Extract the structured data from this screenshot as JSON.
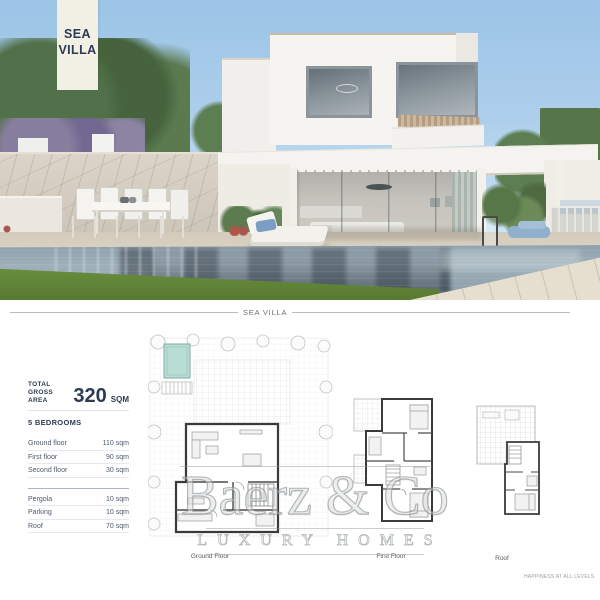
{
  "banner": {
    "line1": "SEA",
    "line2": "VILLA"
  },
  "section_title": "SEA VILLA",
  "info": {
    "total_label_line1": "TOTAL",
    "total_label_line2": "GROSS AREA",
    "total_value": "320",
    "total_unit": "SQM",
    "bedrooms_label": "5 BEDROOMS",
    "area_rows": [
      {
        "label": "Ground floor",
        "value": "110 sqm"
      },
      {
        "label": "First floor",
        "value": "90 sqm"
      },
      {
        "label": "Second floor",
        "value": "30 sqm"
      }
    ],
    "extra_rows": [
      {
        "label": "Pergola",
        "value": "10 sqm"
      },
      {
        "label": "Parking",
        "value": "10 sqm"
      },
      {
        "label": "Roof",
        "value": "70 sqm"
      }
    ]
  },
  "plans": {
    "ground": {
      "label": "Ground Floor"
    },
    "first": {
      "label": "First Floor"
    },
    "roof": {
      "label": "Roof"
    }
  },
  "watermark": {
    "name": "Baerz & Co",
    "tagline": "LUXURY HOMES"
  },
  "footer_note": "HAPPINESS AT ALL LEVELS",
  "colors": {
    "banner_bg": "#f2efe4",
    "navy": "#2c3b53",
    "plan_pool": "#b9dcd4",
    "plan_wall": "#3a3a3a",
    "watermark_gray": "#a7adb2"
  }
}
